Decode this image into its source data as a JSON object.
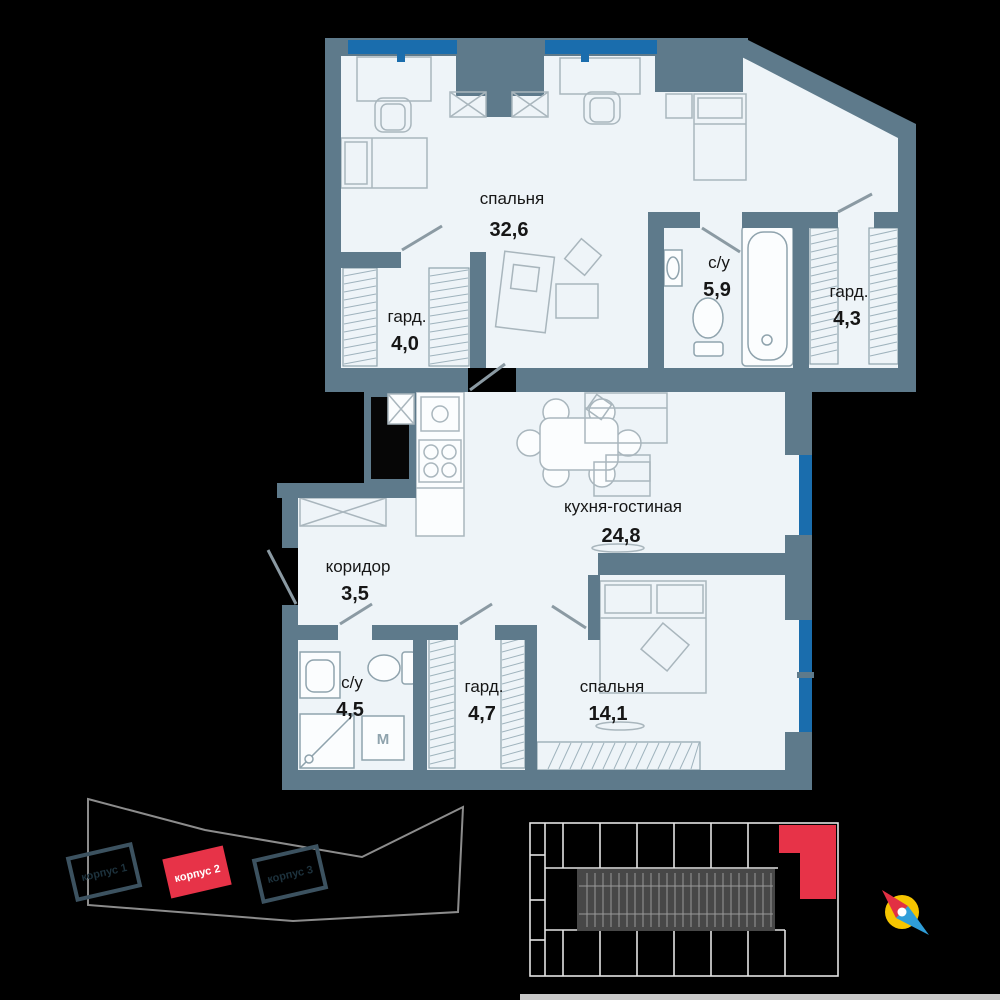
{
  "colors": {
    "wall": "#5e7a8b",
    "floor": "#eef4f8",
    "window_blue": "#1a6dad",
    "accent_red": "#e73348",
    "compass_yellow": "#f6c500"
  },
  "plan": {
    "rooms": [
      {
        "name": "спальня",
        "area": "32,6"
      },
      {
        "name": "с/у",
        "area": "5,9"
      },
      {
        "name": "гард.",
        "area": "4,3"
      },
      {
        "name": "гард.",
        "area": "4,0"
      },
      {
        "name": "кухня-гостиная",
        "area": "24,8"
      },
      {
        "name": "коридор",
        "area": "3,5"
      },
      {
        "name": "с/у",
        "area": "4,5"
      },
      {
        "name": "гард.",
        "area": "4,7"
      },
      {
        "name": "спальня",
        "area": "14,1"
      }
    ],
    "washer_label": "M"
  },
  "site_plan": {
    "buildings": [
      {
        "label": "корпус 1",
        "highlighted": false
      },
      {
        "label": "корпус 2",
        "highlighted": true
      },
      {
        "label": "корпус 3",
        "highlighted": false
      }
    ]
  }
}
